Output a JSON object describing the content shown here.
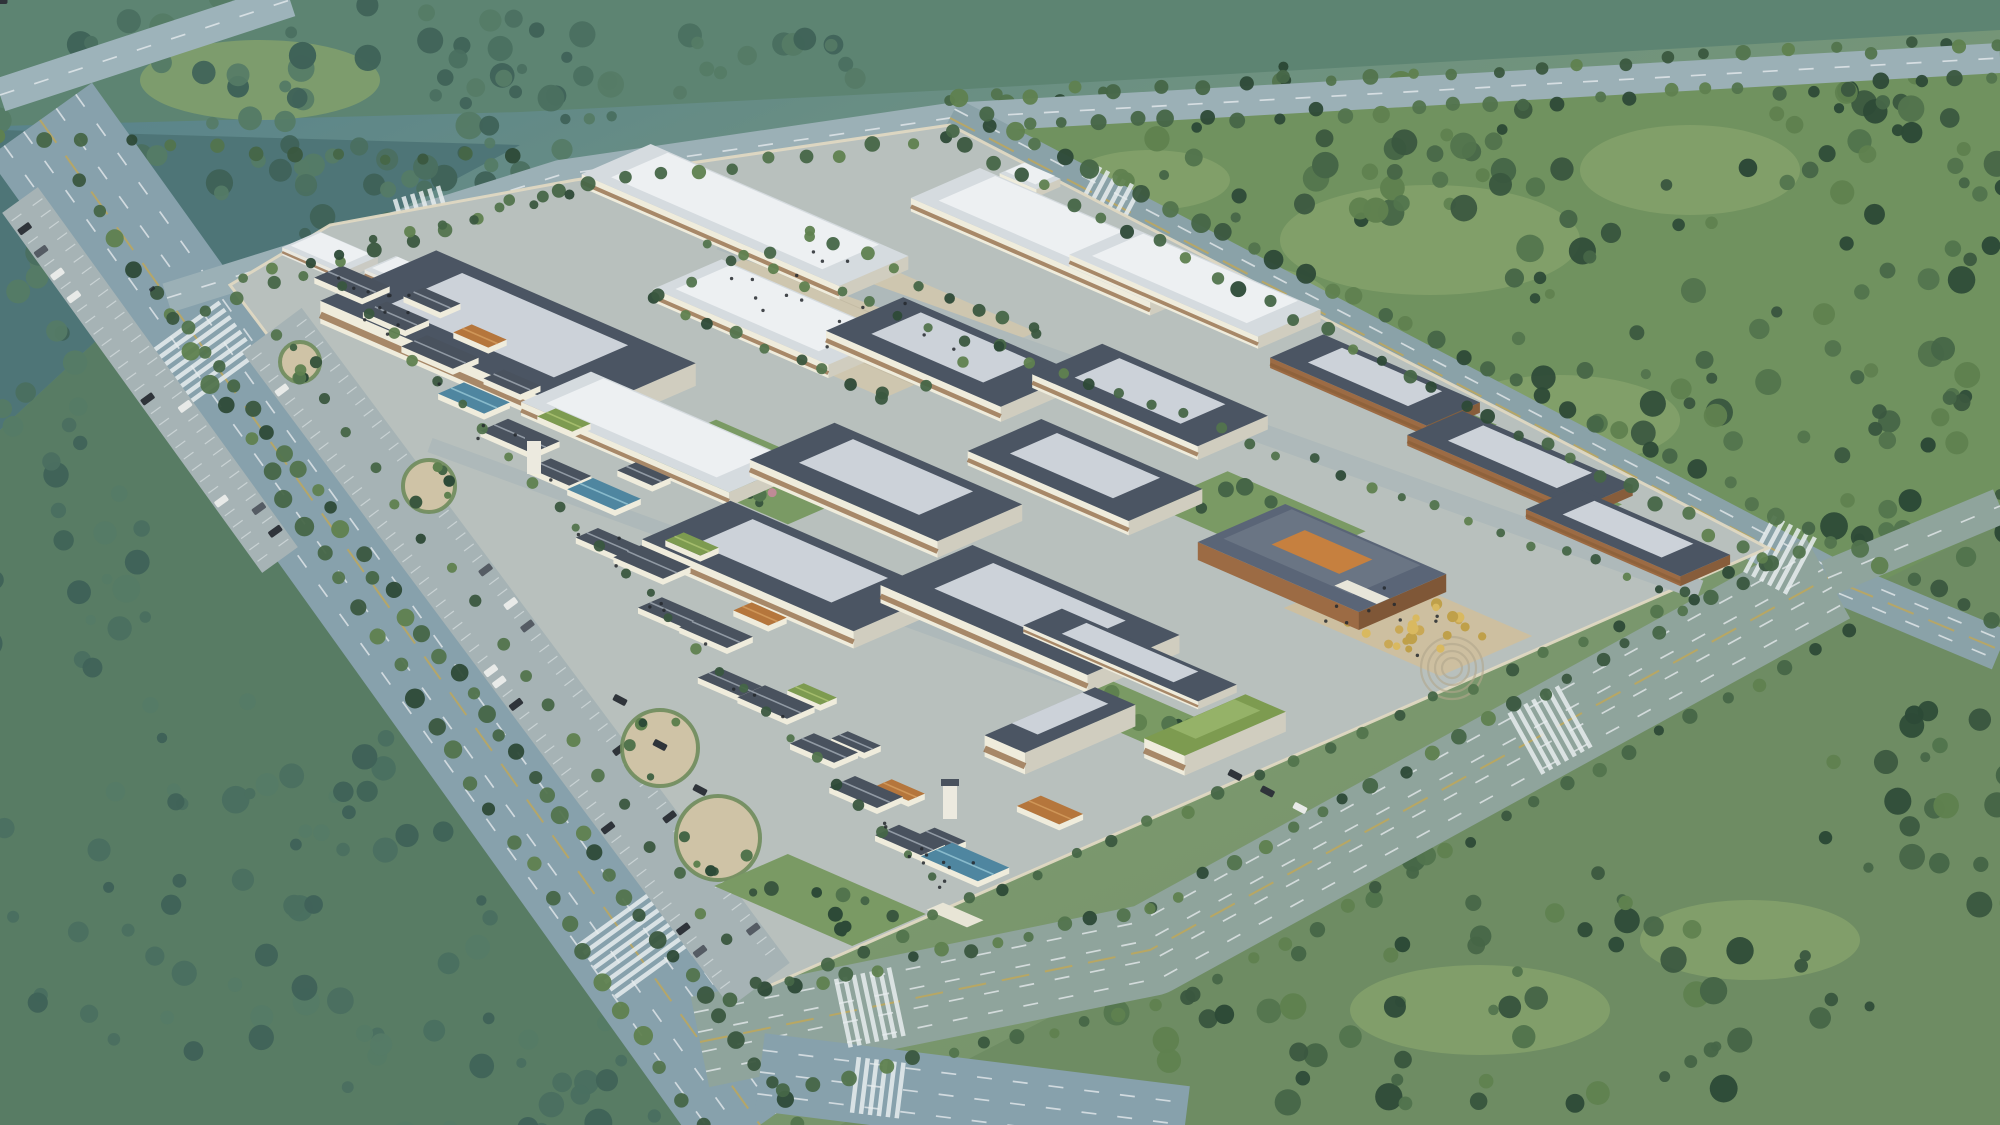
{
  "labels": {
    "view_title": "鸟瞰图",
    "credit": "山东省医药工业设计院"
  },
  "palette": {
    "bg_stops": [
      "#54808f",
      "#6d9181",
      "#7c996e",
      "#73906a"
    ],
    "mist": "#d6e9ec",
    "tint": "#56869a",
    "road": "#8aa3ad",
    "road_green": "#91a89f",
    "lane_white": "#e9eef0",
    "lane_yellow": "#c9a84c",
    "campus_paving": "#b8c0bd",
    "campus_wall": "#dfd8c2",
    "plaza": "#cec6af",
    "plaza_line": "#bdb49e",
    "parking": "#a6b3b5",
    "wall_cream": "#efecdc",
    "window_brown": "#8a5f38",
    "roof_slate": "#4b5563",
    "roof_slate_top": "#ccd2d9",
    "roof_white": "#d5dbdf",
    "roof_white_top": "#edf0f2",
    "roof_green": "#7d9b50",
    "roof_green_top": "#95b268",
    "hut_slate": "#49525e",
    "hut_green": "#7d9b50",
    "hut_orange": "#b5763c",
    "hut_glass": "#4f86a0",
    "hut_white": "#e9e8e0",
    "admin_roof": "#5a6577",
    "admin_wall": "#9c6b44",
    "admin_court": "#c6803f",
    "gold_plaza": "#cdbfa0",
    "amp_ring": "#b0a78c",
    "garden_grass": "#7a9a64",
    "tree_greens": [
      "#2d4a37",
      "#3a573f",
      "#466647",
      "#52744d",
      "#5f814f"
    ],
    "tree_misty": [
      "#3f6258",
      "#4a6f60",
      "#557b66"
    ],
    "tree_gold": [
      "#c9a855",
      "#d9b960",
      "#bfa04a"
    ],
    "tree_pink": "#c08a96",
    "people": "#24292e",
    "car_dark": "#2f343a",
    "car_white": "#e8eae8",
    "car_red": "#a33425",
    "car_tan": "#c2a96a"
  },
  "scene": {
    "fields": [
      {
        "p": "0,0 2000,0 2000,30 950,90 520,112 0,126",
        "f": "#5d8472"
      },
      {
        "p": "0,130 520,145 300,262 140,300 0,430",
        "f": "#4e7577"
      },
      {
        "p": "960,125 2000,66 2000,645 1840,577",
        "f": "#70925f"
      },
      {
        "p": "0,430 140,300 760,1125 0,1125",
        "f": "#587c64"
      },
      {
        "p": "840,1125 1165,958 1840,602 2000,522 2000,1125",
        "f": "#6e8c63"
      }
    ],
    "patches": [
      [
        1430,
        240,
        150,
        55
      ],
      [
        1690,
        170,
        110,
        45
      ],
      [
        1240,
        300,
        90,
        35
      ],
      [
        1560,
        420,
        120,
        45
      ],
      [
        1480,
        1010,
        130,
        45
      ],
      [
        1750,
        940,
        110,
        40
      ],
      [
        260,
        80,
        120,
        40
      ],
      [
        1150,
        180,
        80,
        30
      ]
    ],
    "forests": [
      [
        300,
        95,
        320,
        105,
        62,
        1
      ],
      [
        90,
        320,
        130,
        150,
        28,
        1
      ],
      [
        430,
        195,
        170,
        62,
        24,
        1
      ],
      [
        700,
        62,
        180,
        38,
        16,
        1
      ],
      [
        1270,
        150,
        320,
        85,
        55,
        0
      ],
      [
        1760,
        310,
        270,
        150,
        60,
        0
      ],
      [
        1905,
        120,
        170,
        85,
        30,
        0
      ],
      [
        1930,
        480,
        120,
        85,
        22,
        0
      ],
      [
        1480,
        985,
        400,
        135,
        68,
        0
      ],
      [
        1950,
        810,
        140,
        110,
        26,
        0
      ],
      [
        230,
        880,
        270,
        185,
        56,
        1
      ],
      [
        520,
        1080,
        210,
        70,
        28,
        1
      ],
      [
        60,
        590,
        100,
        130,
        20,
        1
      ]
    ],
    "roads": [
      {
        "pts": [
          [
            0,
            95
          ],
          [
            290,
            0
          ]
        ],
        "w": 34,
        "c": "#9db3ba",
        "lanes": [
          0
        ]
      },
      {
        "pts": [
          [
            40,
            120
          ],
          [
            760,
            1125
          ]
        ],
        "w": 128,
        "c": "#87a1ac",
        "lanes": [
          -44,
          -20,
          20,
          44
        ],
        "yellow": 0
      },
      {
        "pts": [
          [
            167,
            298
          ],
          [
            560,
            175
          ],
          [
            950,
            118
          ],
          [
            2000,
            58
          ]
        ],
        "w": 30,
        "c": "#9bb0b6",
        "lanes": [
          0
        ]
      },
      {
        "pts": [
          [
            950,
            118
          ],
          [
            1828,
            578
          ],
          [
            2000,
            650
          ]
        ],
        "w": 42,
        "c": "#8aa2a8",
        "lanes": [
          -10,
          10
        ],
        "yellow": 0
      },
      {
        "pts": [
          [
            700,
            1042
          ],
          [
            1150,
            950
          ],
          [
            1828,
            578
          ]
        ],
        "w": 92,
        "c": "#8fa49c",
        "lanes": [
          -30,
          -10,
          10,
          30
        ],
        "yellow": 0
      },
      {
        "pts": [
          [
            1828,
            578
          ],
          [
            2000,
            506
          ]
        ],
        "w": 36,
        "c": "#8fa49c",
        "lanes": [
          0
        ]
      },
      {
        "pts": [
          [
            760,
            1072
          ],
          [
            1185,
            1125
          ]
        ],
        "w": 78,
        "c": "#87a1ac",
        "lanes": [
          -22,
          0,
          22
        ]
      }
    ],
    "crosswalks": [
      [
        205,
        355,
        54,
        86,
        8
      ],
      [
        633,
        948,
        54,
        86,
        8
      ],
      [
        425,
        213,
        -17,
        44,
        6
      ],
      [
        872,
        1007,
        -12,
        70,
        7
      ],
      [
        1552,
        729,
        -29,
        70,
        7
      ],
      [
        1108,
        205,
        28,
        60,
        6
      ],
      [
        1782,
        556,
        28,
        64,
        6
      ],
      [
        880,
        1088,
        7,
        56,
        6
      ]
    ],
    "campus": {
      "p": "230,285 330,225 575,180 950,125 1768,548 760,990"
    },
    "parking_e": {
      "pts": [
        [
          272,
          330
        ],
        [
          760,
          985
        ]
      ],
      "w": 74
    },
    "parking_w": {
      "pts": [
        [
          20,
          200
        ],
        [
          280,
          560
        ]
      ],
      "w": 44
    },
    "circles": [
      [
        300,
        362,
        20
      ],
      [
        429,
        486,
        26
      ],
      [
        660,
        748,
        38
      ],
      [
        718,
        838,
        42
      ]
    ],
    "plaza": {
      "cx": 845,
      "cy": 315,
      "a": 250,
      "b": 165
    },
    "service_roads": [
      {
        "pts": [
          [
            720,
            240
          ],
          [
            1700,
            590
          ]
        ],
        "w": 20
      },
      {
        "pts": [
          [
            430,
            445
          ],
          [
            1100,
            690
          ]
        ],
        "w": 15
      }
    ],
    "gardens": [
      [
        752,
        472,
        170,
        92,
        10,
        2
      ],
      [
        1258,
        518,
        150,
        84,
        9,
        0
      ],
      [
        1135,
        715,
        110,
        60,
        6,
        0
      ],
      [
        820,
        900,
        150,
        80,
        10,
        0
      ]
    ],
    "courts": [
      [
        1448,
        418,
        70,
        36
      ],
      [
        1576,
        498,
        66,
        34
      ]
    ],
    "buildings": [
      [
        745,
        215,
        280,
        75,
        "w"
      ],
      [
        1065,
        235,
        260,
        75,
        "w"
      ],
      [
        1195,
        282,
        205,
        68,
        "w"
      ],
      [
        1030,
        176,
        40,
        26,
        "w"
      ],
      [
        508,
        332,
        282,
        126,
        "s"
      ],
      [
        775,
        312,
        190,
        74,
        "w"
      ],
      [
        952,
        352,
        190,
        84,
        "s"
      ],
      [
        1150,
        395,
        180,
        76,
        "s"
      ],
      [
        660,
        432,
        226,
        76,
        "w"
      ],
      [
        886,
        482,
        204,
        92,
        "s"
      ],
      [
        1085,
        470,
        175,
        80,
        "s"
      ],
      [
        792,
        566,
        230,
        96,
        "s"
      ],
      [
        1030,
        610,
        225,
        100,
        "s"
      ],
      [
        1130,
        655,
        190,
        42,
        "s"
      ],
      [
        1060,
        720,
        44,
        120,
        "s"
      ],
      [
        1215,
        725,
        44,
        110,
        "g"
      ]
    ],
    "dorms": [
      [
        1375,
        380,
        170,
        58
      ],
      [
        1520,
        460,
        185,
        60
      ],
      [
        1628,
        532,
        168,
        54
      ]
    ],
    "white_blocks": [
      [
        330,
        252,
        64,
        40
      ],
      [
        406,
        274,
        56,
        34
      ]
    ],
    "admin": {
      "cx": 1322,
      "cy": 558,
      "a": 175,
      "b": 95
    },
    "gold_plaza": {
      "cx": 1408,
      "cy": 622,
      "a": 170,
      "b": 100,
      "trees": 22,
      "amp": {
        "x": 1452,
        "y": 668,
        "rs": [
          10,
          17,
          24,
          31
        ]
      }
    },
    "street": {
      "p1": [
        335,
        272
      ],
      "p2": [
        940,
        890
      ]
    },
    "huts": [
      [
        352,
        282,
        52,
        30,
        "slate"
      ],
      [
        396,
        316,
        46,
        26,
        "slate"
      ],
      [
        432,
        300,
        40,
        22,
        "slate"
      ],
      [
        440,
        352,
        56,
        28,
        "slate"
      ],
      [
        480,
        336,
        38,
        20,
        "orange"
      ],
      [
        474,
        398,
        50,
        28,
        "glass"
      ],
      [
        512,
        382,
        40,
        22,
        "slate"
      ],
      [
        520,
        436,
        56,
        30,
        "slate"
      ],
      [
        564,
        420,
        38,
        20,
        "green"
      ],
      [
        560,
        472,
        44,
        24,
        "slate"
      ],
      [
        604,
        494,
        52,
        28,
        "glass"
      ],
      [
        644,
        474,
        38,
        20,
        "slate"
      ],
      [
        608,
        542,
        46,
        24,
        "slate"
      ],
      [
        652,
        562,
        54,
        30,
        "slate"
      ],
      [
        692,
        544,
        38,
        20,
        "green"
      ],
      [
        672,
        612,
        48,
        26,
        "slate"
      ],
      [
        716,
        632,
        52,
        28,
        "slate"
      ],
      [
        760,
        614,
        38,
        20,
        "orange"
      ],
      [
        730,
        682,
        46,
        24,
        "slate"
      ],
      [
        776,
        702,
        54,
        30,
        "slate"
      ],
      [
        812,
        694,
        36,
        18,
        "green"
      ],
      [
        824,
        748,
        48,
        26,
        "slate"
      ],
      [
        856,
        742,
        36,
        18,
        "slate"
      ],
      [
        866,
        792,
        52,
        28,
        "slate"
      ],
      [
        900,
        790,
        36,
        18,
        "orange"
      ],
      [
        910,
        840,
        50,
        26,
        "slate"
      ],
      [
        942,
        838,
        34,
        18,
        "slate"
      ],
      [
        1050,
        810,
        46,
        26,
        "orange"
      ],
      [
        965,
        862,
        62,
        34,
        "glass"
      ]
    ],
    "towers": [
      [
        534,
        470
      ],
      [
        950,
        815
      ]
    ],
    "gate": [
      955,
      915,
      44,
      18
    ],
    "parked_rows": [
      [
        [
          1235,
          775
        ],
        [
          1300,
          808
        ],
        3
      ],
      [
        [
          620,
          700
        ],
        [
          700,
          790
        ],
        3
      ]
    ],
    "tree_rows": [
      [
        170,
        318,
        545,
        192,
        12,
        5,
        8
      ],
      [
        555,
        190,
        945,
        138,
        12,
        5,
        8
      ],
      [
        955,
        132,
        1990,
        78,
        30,
        5,
        9
      ],
      [
        0,
        140,
        510,
        160,
        13,
        5,
        8
      ],
      [
        950,
        98,
        2000,
        42,
        26,
        5,
        8
      ],
      [
        960,
        100,
        1990,
        620,
        40,
        6,
        10
      ],
      [
        965,
        145,
        1768,
        560,
        30,
        5,
        8
      ],
      [
        188,
        330,
        800,
        1120,
        40,
        6,
        9
      ],
      [
        80,
        180,
        700,
        1125,
        34,
        6,
        10
      ],
      [
        730,
        1000,
        1150,
        908,
        15,
        5,
        8
      ],
      [
        1150,
        908,
        1795,
        552,
        24,
        5,
        8
      ],
      [
        780,
        1090,
        1190,
        998,
        13,
        5,
        8
      ],
      [
        1190,
        995,
        1850,
        628,
        22,
        5,
        8
      ],
      [
        345,
        290,
        930,
        880,
        26,
        4,
        6
      ],
      [
        272,
        335,
        752,
        978,
        20,
        5,
        7
      ],
      [
        806,
        232,
        1036,
        332,
        9,
        5,
        7
      ],
      [
        654,
        298,
        884,
        398,
        9,
        5,
        7
      ],
      [
        806,
        232,
        654,
        298,
        5,
        5,
        7
      ],
      [
        1036,
        332,
        884,
        398,
        5,
        5,
        7
      ],
      [
        712,
        248,
        1690,
        598,
        32,
        4,
        6
      ],
      [
        1760,
        560,
        790,
        980,
        28,
        5,
        7
      ],
      [
        240,
        278,
        570,
        192,
        11,
        4,
        6
      ]
    ],
    "people_regions": [
      [
        845,
        315,
        220,
        140,
        16
      ],
      [
        1408,
        622,
        150,
        88,
        10
      ],
      [
        380,
        300,
        90,
        54,
        8
      ],
      [
        930,
        860,
        80,
        46,
        8
      ]
    ],
    "street_people": 22,
    "cars": [
      [
        150,
        286,
        54,
        "car_dark",
        15
      ],
      [
        198,
        352,
        54,
        "car_white",
        15
      ],
      [
        258,
        444,
        54,
        "car_dark",
        15
      ],
      [
        232,
        402,
        54,
        "car_red",
        26
      ],
      [
        292,
        474,
        54,
        "car_white",
        26
      ],
      [
        352,
        562,
        54,
        "car_dark",
        15
      ],
      [
        420,
        656,
        54,
        "car_white",
        15
      ],
      [
        462,
        730,
        54,
        "car_dark",
        15
      ],
      [
        530,
        816,
        54,
        "car_dark",
        15
      ],
      [
        600,
        912,
        54,
        "car_white",
        15
      ],
      [
        668,
        1006,
        54,
        "car_dark",
        15
      ],
      [
        726,
        1084,
        54,
        "car_dark",
        15
      ],
      [
        96,
        204,
        54,
        "car_white",
        15
      ],
      [
        940,
        1012,
        -12,
        "car_dark",
        15
      ],
      [
        1080,
        970,
        -12,
        "car_white",
        15
      ],
      [
        1240,
        906,
        -29,
        "car_dark",
        15
      ],
      [
        1380,
        830,
        -29,
        "car_red",
        15
      ],
      [
        1520,
        752,
        -29,
        "car_dark",
        15
      ],
      [
        1650,
        686,
        -29,
        "car_white",
        15
      ],
      [
        1735,
        638,
        -29,
        "car_tan",
        26
      ],
      [
        1270,
        290,
        28,
        "car_white",
        15
      ],
      [
        1405,
        362,
        28,
        "car_dark",
        15
      ],
      [
        1545,
        436,
        28,
        "car_red",
        13
      ],
      [
        1890,
        608,
        28,
        "car_white",
        15
      ],
      [
        435,
        225,
        -17,
        "car_white",
        13
      ],
      [
        628,
        168,
        -18,
        "car_red",
        26
      ],
      [
        1260,
        100,
        -3,
        "car_dark",
        18
      ],
      [
        1490,
        86,
        -3,
        "car_white",
        13
      ],
      [
        1010,
        1102,
        7,
        "car_dark",
        15
      ],
      [
        1920,
        532,
        -24,
        "car_white",
        13
      ],
      [
        60,
        60,
        -18,
        "car_dark",
        13
      ]
    ],
    "mist": [
      [
        210,
        140,
        460,
        210,
        0.52
      ],
      [
        640,
        70,
        420,
        110,
        0.4
      ],
      [
        55,
        540,
        240,
        300,
        0.46
      ],
      [
        1760,
        210,
        330,
        170,
        0.28
      ],
      [
        1120,
        40,
        420,
        80,
        0.3
      ],
      [
        140,
        940,
        330,
        210,
        0.34
      ],
      [
        1880,
        1060,
        260,
        120,
        0.22
      ],
      [
        460,
        330,
        220,
        140,
        0.25
      ]
    ]
  }
}
